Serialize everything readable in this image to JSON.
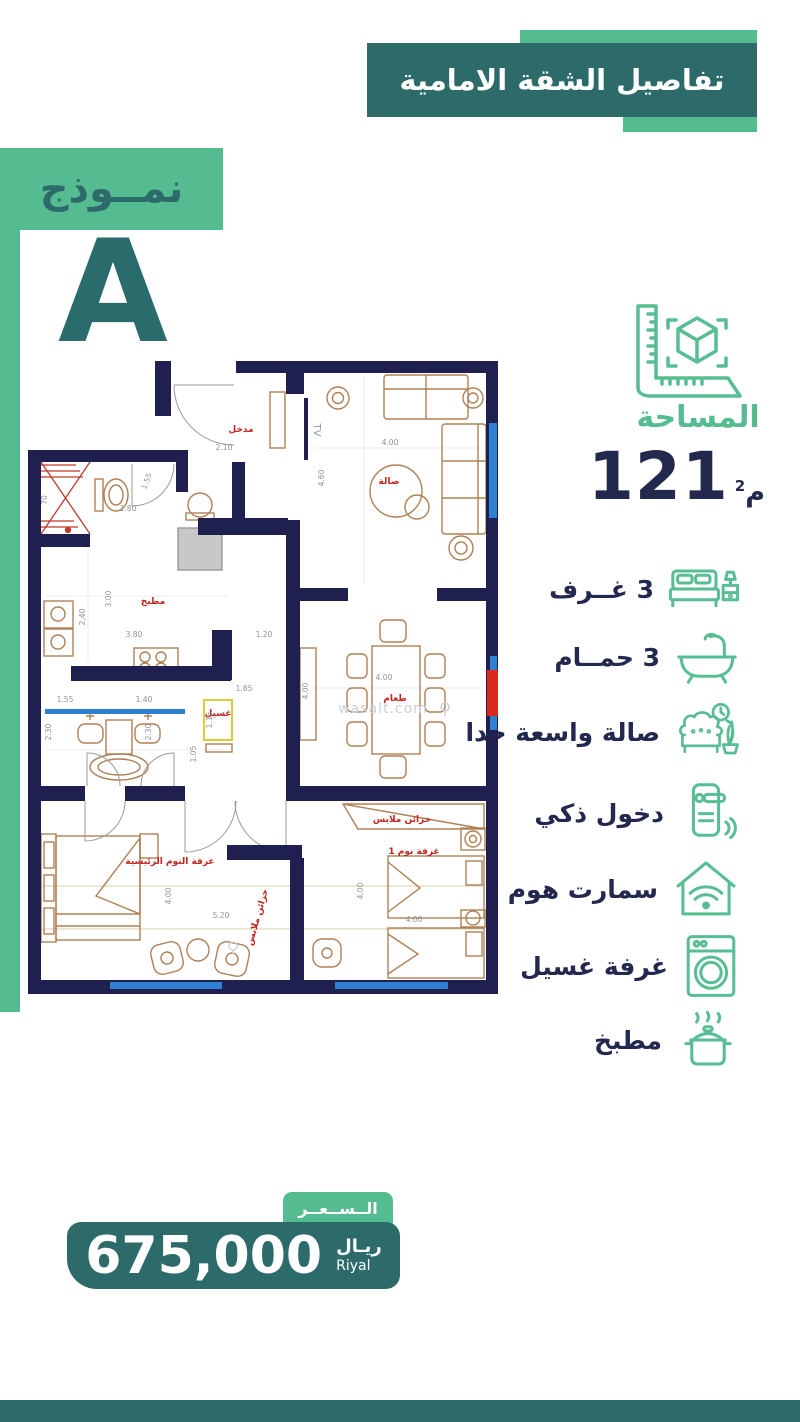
{
  "colors": {
    "teal": "#2d6b6b",
    "green": "#55bb90",
    "navy": "#23284f",
    "wall": "#1f2050",
    "red": "#c3241d",
    "blue": "#2f80d0",
    "yellow": "#d8ce3a"
  },
  "header": {
    "title": "تفاصيل الشقة الامامية"
  },
  "model": {
    "label": "نمــوذج",
    "letter": "A"
  },
  "area": {
    "label": "المساحة",
    "value": "121",
    "unit": "م",
    "unit_sup": "2"
  },
  "features": [
    {
      "icon": "bed-icon",
      "label": "3 غــرف"
    },
    {
      "icon": "bathtub-icon",
      "label": "3 حمــام"
    },
    {
      "icon": "sofa-icon",
      "label": "صالة واسعة جدا"
    },
    {
      "icon": "smart-lock-icon",
      "label": "دخول ذكي"
    },
    {
      "icon": "smart-home-icon",
      "label": "سمارت هوم"
    },
    {
      "icon": "washing-machine-icon",
      "label": "غرفة غسيل"
    },
    {
      "icon": "cooking-pot-icon",
      "label": "مطبخ"
    }
  ],
  "price": {
    "label": "الــســعــر",
    "value": "675,000",
    "currency_ar": "ريـال",
    "currency_en": "Riyal"
  },
  "floor_plan": {
    "watermark": "wasalt.com",
    "tv_label": "TV",
    "shaft_label": "70",
    "rooms": [
      "مدخل",
      "صالة",
      "مطبخ",
      "طعام",
      "غسيل",
      "خزائن ملابس",
      "خزائن ملابس",
      "غرفة النوم الرئيسية",
      "غرفة نوم 1"
    ],
    "dims": [
      "2.10",
      "4.00",
      "4.60",
      "1.55",
      "1.80",
      "3.00",
      "2.40",
      "3.80",
      "1.20",
      "1.85",
      "1.55",
      "1.40",
      "2.30",
      "2.30",
      "1.15",
      "1.05",
      "5.20",
      "4.00",
      "4.00",
      "4.00",
      "4.00",
      "4.00"
    ]
  }
}
